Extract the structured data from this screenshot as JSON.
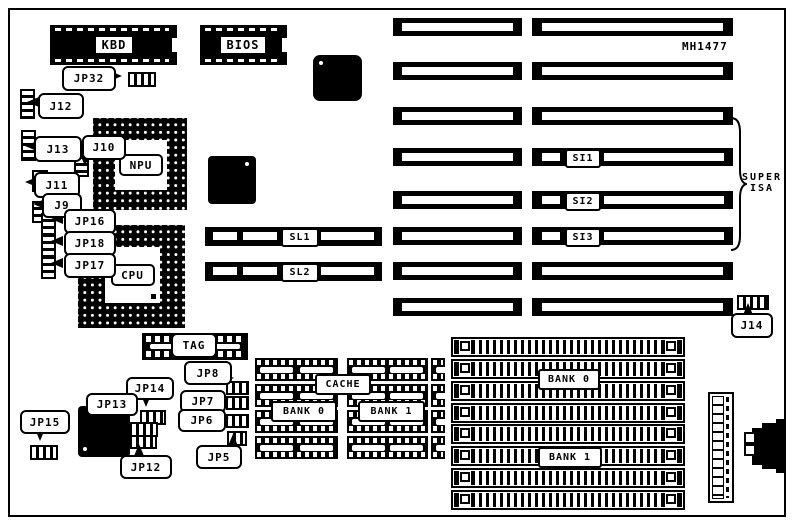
{
  "board": {
    "part_number": "MH1477",
    "bus_brace": {
      "line1": "SUPER",
      "line2": "ISA"
    }
  },
  "labels": {
    "kbd": "KBD",
    "bios": "BIOS",
    "npu": "NPU",
    "cpu": "CPU",
    "tag": "TAG",
    "cache": "CACHE",
    "cache_bank0": "BANK 0",
    "cache_bank1": "BANK 1",
    "mem_bank0": "BANK 0",
    "mem_bank1": "BANK 1",
    "sl1": "SL1",
    "sl2": "SL2",
    "si1": "SI1",
    "si2": "SI2",
    "si3": "SI3",
    "jp32": "JP32",
    "j12": "J12",
    "j13": "J13",
    "j10": "J10",
    "j11": "J11",
    "j9": "J9",
    "jp16": "JP16",
    "jp18": "JP18",
    "jp17": "JP17",
    "jp8": "JP8",
    "jp7": "JP7",
    "jp6": "JP6",
    "jp5": "JP5",
    "jp14": "JP14",
    "jp13": "JP13",
    "jp12": "JP12",
    "jp15": "JP15",
    "j14": "J14"
  },
  "colors": {
    "ink": "#000000",
    "paper": "#ffffff"
  }
}
